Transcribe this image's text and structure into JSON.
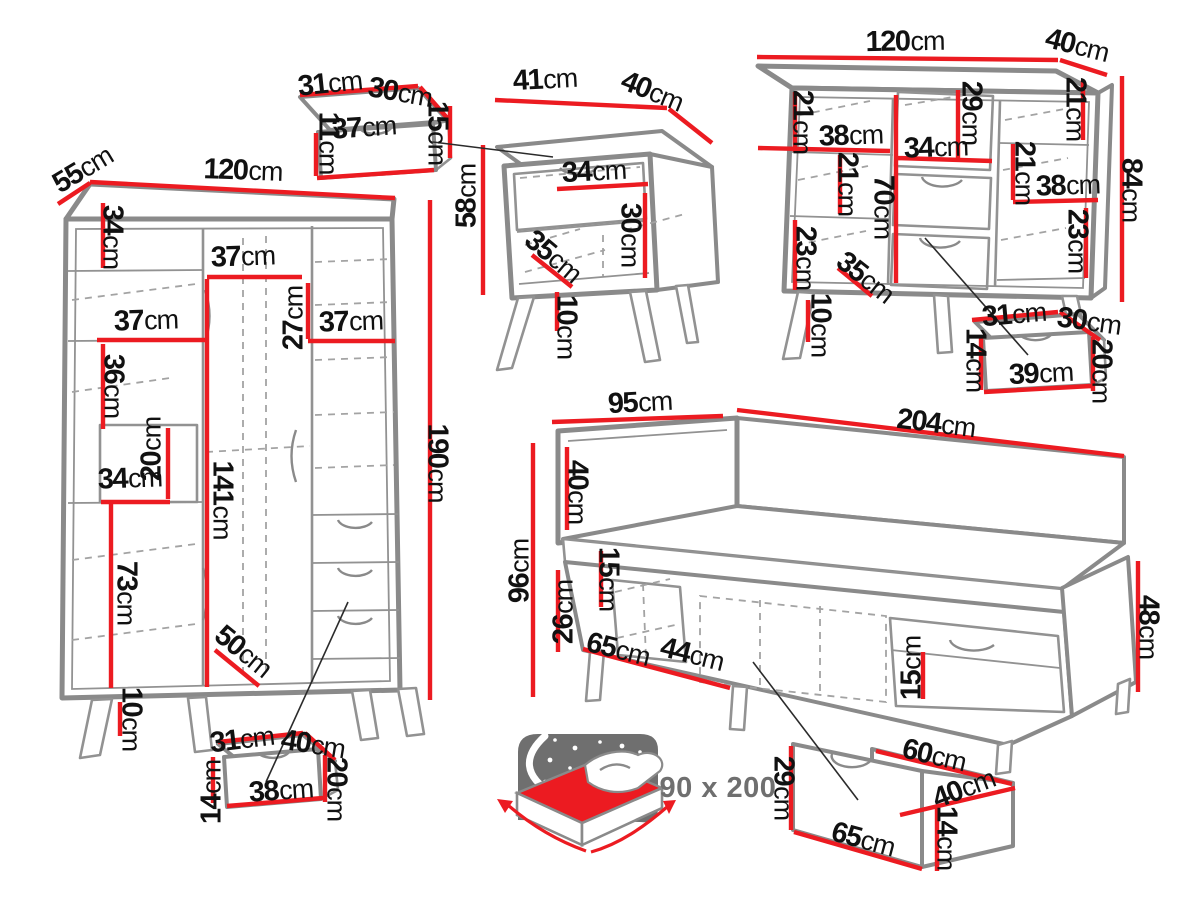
{
  "diagram": {
    "description": "Bedroom furniture set dimensions diagram",
    "unit": "cm"
  },
  "colors": {
    "dimension_line": "#ec1b21",
    "outline_gray": "#8a8a8a",
    "dashed_gray": "#a3a3a3",
    "text_black": "#111111",
    "badge_gray": "#6f6f6f",
    "background": "#ffffff"
  },
  "mattress_size": {
    "text": "90 x 200"
  },
  "pieces": [
    {
      "id": "wardrobe",
      "dims": [
        {
          "n": "depth",
          "v": "55",
          "x": 83,
          "y": 170,
          "r": -31
        },
        {
          "n": "width",
          "v": "120",
          "x": 243,
          "y": 171,
          "r": 2
        },
        {
          "n": "top-section-height",
          "v": "34",
          "x": 112,
          "y": 237,
          "r": 90
        },
        {
          "n": "middle-section-width",
          "v": "37",
          "x": 243,
          "y": 257,
          "r": -2
        },
        {
          "n": "upper-right-height",
          "v": "27",
          "x": 294,
          "y": 318,
          "r": -90
        },
        {
          "n": "right-shelf-width",
          "v": "37",
          "x": 351,
          "y": 322,
          "r": -2
        },
        {
          "n": "left-shelf-width",
          "v": "37",
          "x": 146,
          "y": 321,
          "r": -2
        },
        {
          "n": "left-section-height",
          "v": "36",
          "x": 113,
          "y": 386,
          "r": 90
        },
        {
          "n": "cubby-height",
          "v": "20",
          "x": 152,
          "y": 449,
          "r": -90
        },
        {
          "n": "cubby-width",
          "v": "34",
          "x": 130,
          "y": 479,
          "r": -2
        },
        {
          "n": "hanging-space-height",
          "v": "141",
          "x": 222,
          "y": 500,
          "r": 90
        },
        {
          "n": "lower-left-height",
          "v": "73",
          "x": 126,
          "y": 593,
          "r": 90
        },
        {
          "n": "interior-depth",
          "v": "50",
          "x": 243,
          "y": 652,
          "r": 39
        },
        {
          "n": "leg-height",
          "v": "10",
          "x": 131,
          "y": 719,
          "r": 90
        },
        {
          "n": "height",
          "v": "190",
          "x": 437,
          "y": 463,
          "r": 90
        }
      ]
    },
    {
      "id": "wardrobe-drawer",
      "dims": [
        {
          "n": "top-width",
          "v": "31",
          "x": 242,
          "y": 740,
          "r": -7
        },
        {
          "n": "top-depth",
          "v": "40",
          "x": 313,
          "y": 745,
          "r": 9
        },
        {
          "n": "left-height",
          "v": "14",
          "x": 212,
          "y": 792,
          "r": -90
        },
        {
          "n": "front-width",
          "v": "38",
          "x": 281,
          "y": 791,
          "r": -4
        },
        {
          "n": "right-height",
          "v": "20",
          "x": 336,
          "y": 789,
          "r": 90
        }
      ]
    },
    {
      "id": "nightstand-drawer",
      "dims": [
        {
          "n": "top-width",
          "v": "31",
          "x": 330,
          "y": 84,
          "r": -6
        },
        {
          "n": "top-depth",
          "v": "30",
          "x": 400,
          "y": 93,
          "r": 10
        },
        {
          "n": "left-height",
          "v": "11",
          "x": 328,
          "y": 143,
          "r": 90
        },
        {
          "n": "front-width",
          "v": "37",
          "x": 364,
          "y": 128,
          "r": -4
        },
        {
          "n": "right-height",
          "v": "15",
          "x": 437,
          "y": 133,
          "r": 90
        }
      ]
    },
    {
      "id": "nightstand",
      "dims": [
        {
          "n": "width",
          "v": "41",
          "x": 545,
          "y": 80,
          "r": -3
        },
        {
          "n": "depth",
          "v": "40",
          "x": 652,
          "y": 92,
          "r": 22
        },
        {
          "n": "height",
          "v": "58",
          "x": 467,
          "y": 196,
          "r": -90
        },
        {
          "n": "shelf-width",
          "v": "34",
          "x": 594,
          "y": 172,
          "r": -3
        },
        {
          "n": "shelf-height",
          "v": "30",
          "x": 630,
          "y": 235,
          "r": 90
        },
        {
          "n": "interior-depth",
          "v": "35",
          "x": 553,
          "y": 257,
          "r": 40
        },
        {
          "n": "leg-height",
          "v": "10",
          "x": 566,
          "y": 327,
          "r": 90
        }
      ]
    },
    {
      "id": "chest",
      "dims": [
        {
          "n": "width",
          "v": "120",
          "x": 905,
          "y": 42,
          "r": -1
        },
        {
          "n": "depth",
          "v": "40",
          "x": 1077,
          "y": 46,
          "r": 14
        },
        {
          "n": "top-left-height",
          "v": "21",
          "x": 802,
          "y": 122,
          "r": 90
        },
        {
          "n": "left-shelf-width",
          "v": "38",
          "x": 851,
          "y": 136,
          "r": -2
        },
        {
          "n": "niche-height",
          "v": "29",
          "x": 971,
          "y": 113,
          "r": 90
        },
        {
          "n": "niche-width",
          "v": "34",
          "x": 936,
          "y": 148,
          "r": -2
        },
        {
          "n": "top-right-height",
          "v": "21",
          "x": 1075,
          "y": 109,
          "r": 90
        },
        {
          "n": "mid-left-height",
          "v": "21",
          "x": 847,
          "y": 184,
          "r": 90
        },
        {
          "n": "interior-height",
          "v": "70",
          "x": 883,
          "y": 207,
          "r": 90
        },
        {
          "n": "mid-right-height",
          "v": "21",
          "x": 1024,
          "y": 173,
          "r": 90
        },
        {
          "n": "right-shelf-width",
          "v": "38",
          "x": 1068,
          "y": 186,
          "r": -2
        },
        {
          "n": "bottom-left-height",
          "v": "23",
          "x": 805,
          "y": 258,
          "r": 90
        },
        {
          "n": "interior-depth",
          "v": "35",
          "x": 865,
          "y": 278,
          "r": 38
        },
        {
          "n": "bottom-right-height",
          "v": "23",
          "x": 1077,
          "y": 241,
          "r": 90
        },
        {
          "n": "height",
          "v": "84",
          "x": 1131,
          "y": 190,
          "r": 90
        },
        {
          "n": "leg-height",
          "v": "10",
          "x": 820,
          "y": 325,
          "r": 90
        }
      ]
    },
    {
      "id": "chest-drawer",
      "dims": [
        {
          "n": "top-width",
          "v": "31",
          "x": 1014,
          "y": 315,
          "r": -5
        },
        {
          "n": "top-depth",
          "v": "30",
          "x": 1089,
          "y": 322,
          "r": 8
        },
        {
          "n": "left-height",
          "v": "14",
          "x": 975,
          "y": 360,
          "r": 90
        },
        {
          "n": "front-width",
          "v": "39",
          "x": 1041,
          "y": 374,
          "r": -3
        },
        {
          "n": "right-height",
          "v": "20",
          "x": 1101,
          "y": 371,
          "r": 90
        }
      ]
    },
    {
      "id": "bed",
      "dims": [
        {
          "n": "width",
          "v": "95",
          "x": 640,
          "y": 403,
          "r": -3
        },
        {
          "n": "length",
          "v": "204",
          "x": 936,
          "y": 424,
          "r": 7
        },
        {
          "n": "headboard-height",
          "v": "40",
          "x": 577,
          "y": 492,
          "r": 90
        },
        {
          "n": "height",
          "v": "96",
          "x": 520,
          "y": 571,
          "r": -90
        },
        {
          "n": "mattress-height",
          "v": "15",
          "x": 608,
          "y": 579,
          "r": 90
        },
        {
          "n": "base-height",
          "v": "26",
          "x": 564,
          "y": 612,
          "r": -90
        },
        {
          "n": "niche-width",
          "v": "65",
          "x": 618,
          "y": 650,
          "r": 14
        },
        {
          "n": "niche-width-2",
          "v": "44",
          "x": 692,
          "y": 655,
          "r": 14
        },
        {
          "n": "footboard-height",
          "v": "48",
          "x": 1148,
          "y": 627,
          "r": 90
        },
        {
          "n": "plinth-height",
          "v": "15",
          "x": 912,
          "y": 668,
          "r": -90
        }
      ]
    },
    {
      "id": "bed-drawer",
      "dims": [
        {
          "n": "front-height",
          "v": "29",
          "x": 783,
          "y": 788,
          "r": 90
        },
        {
          "n": "top-length",
          "v": "60",
          "x": 934,
          "y": 756,
          "r": 13
        },
        {
          "n": "top-depth",
          "v": "40",
          "x": 964,
          "y": 789,
          "r": -21
        },
        {
          "n": "front-length",
          "v": "65",
          "x": 863,
          "y": 840,
          "r": 15
        },
        {
          "n": "side-height",
          "v": "14",
          "x": 946,
          "y": 838,
          "r": 90
        }
      ]
    }
  ]
}
